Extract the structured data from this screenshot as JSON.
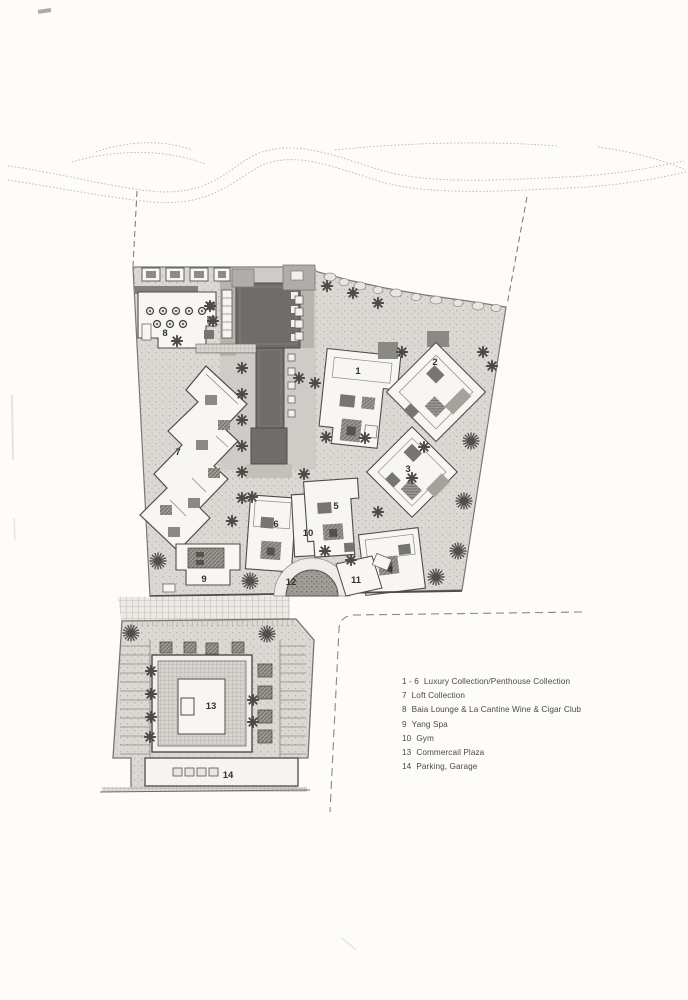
{
  "legend": {
    "items": [
      {
        "num": "1 - 6",
        "label": "Luxury Collection/Penthouse Collection"
      },
      {
        "num": "7",
        "label": "Loft Collection"
      },
      {
        "num": "8",
        "label": "Baia Lounge & La Cantine Wine & Cigar Club"
      },
      {
        "num": "9",
        "label": "Yang Spa"
      },
      {
        "num": "10",
        "label": "Gym"
      },
      {
        "num": "13",
        "label": "Commercail Plaza"
      },
      {
        "num": "14",
        "label": "Parking, Garage"
      }
    ]
  },
  "plan": {
    "labels": {
      "b1": "1",
      "b2": "2",
      "b3": "3",
      "b4": "4",
      "b5": "5",
      "b6": "6",
      "b7": "7",
      "b8": "8",
      "b9": "9",
      "b10": "10",
      "b11": "11",
      "b12": "12",
      "b13": "13",
      "b14": "14"
    }
  },
  "colors": {
    "paper": "#fdfcfa",
    "ground": "#dcd9d4",
    "pool": "#6f6d69",
    "building": "#f7f6f3",
    "line": "#4f4d49",
    "tree": "#4d4b47"
  }
}
